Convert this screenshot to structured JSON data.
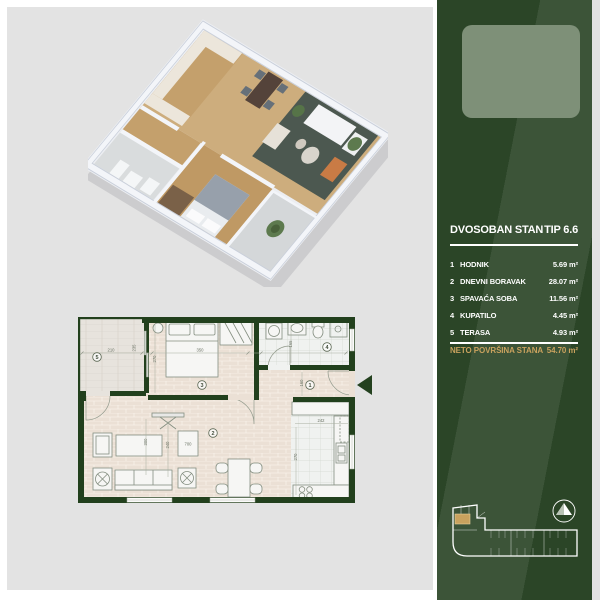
{
  "sidebar": {
    "title": "DVOSOBAN STAN",
    "type": "TIP 6.6",
    "rooms": [
      {
        "num": "1",
        "label": "HODNIK",
        "area": "5.69 m²"
      },
      {
        "num": "2",
        "label": "DNEVNI BORAVAK",
        "area": "28.07 m²"
      },
      {
        "num": "3",
        "label": "SPAVAĆA SOBA",
        "area": "11.56 m²"
      },
      {
        "num": "4",
        "label": "KUPATILO",
        "area": "4.45 m²"
      },
      {
        "num": "5",
        "label": "TERASA",
        "area": "4.93 m²"
      }
    ],
    "total_label": "NETO POVRŠINA STANA",
    "total_area": "54.70 m²",
    "colors": {
      "bg": "#2b4527",
      "gold": "#c9a25e",
      "logo_bg": "#7e9078"
    }
  },
  "floorplan": {
    "rooms": {
      "hall": "1",
      "living": "2",
      "bedroom": "3",
      "bath": "4",
      "terrace": "5"
    },
    "dims": {
      "terrace_w": "210",
      "terrace_d": "235",
      "bedroom_w": "350",
      "bedroom_d": "270",
      "bath_w": "165",
      "hall_w": "160",
      "kitchen_w": "242",
      "kitchen_d": "270",
      "living_a": "300",
      "living_b": "240",
      "living_w": "700"
    },
    "wall_color": "#22401d"
  }
}
